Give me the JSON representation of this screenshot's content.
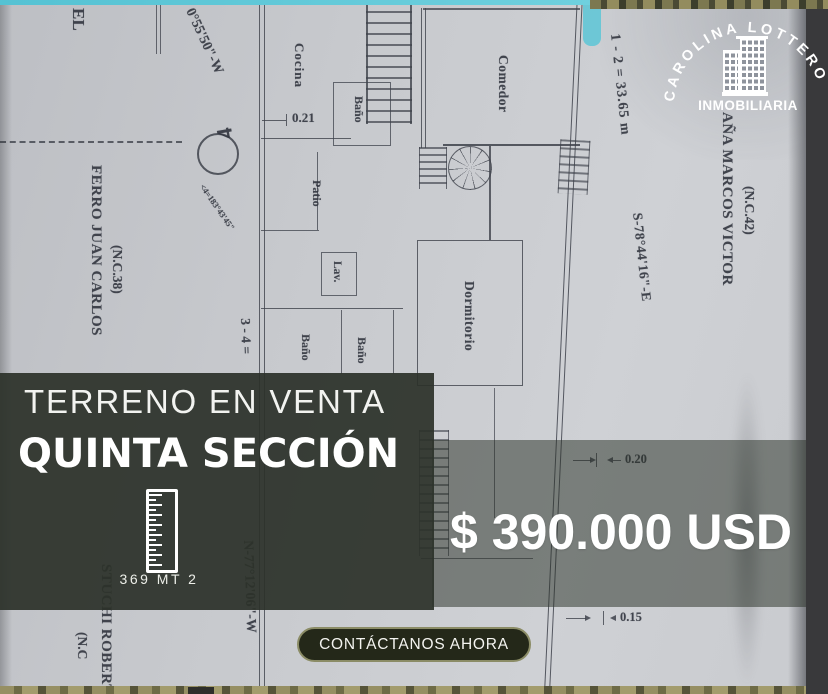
{
  "brand": {
    "arc_text": "CAROLINA LOTTERO",
    "subtitle": "INMOBILIARIA"
  },
  "listing": {
    "headline": "TERRENO EN VENTA",
    "location": "QUINTA SECCIÓN",
    "area_label": "369 MT 2",
    "price": "$ 390.000 USD",
    "cta_label": "CONTÁCTANOS AHORA"
  },
  "plan": {
    "room_labels": {
      "cocina": "Cocina",
      "bano_top": "Baño",
      "patio": "Patio",
      "lav": "Lav.",
      "bano_left": "Baño",
      "bano_mid": "Baño",
      "comedor": "Comedor",
      "dormitorio": "Dormitorio"
    },
    "dimensions": {
      "d021": "0.21",
      "d020": "0.20",
      "d015": "0.15"
    },
    "survey": {
      "bearing_top_left": "0°55'50\"-W",
      "side_1_2": "1 - 2 = 33.65 m",
      "bearing_1_2": "S-78°44'16\"-E",
      "side_3_4": "3 - 4 =",
      "bearing_3_4": "N-77°12'06\"-W",
      "vertex_number": "4",
      "vertex_angle": "<4=183°43'45\""
    },
    "neighbors": {
      "left_name": "FERRO JUAN CARLOS",
      "left_ref": "(N.C.38)",
      "right_name": "AÑA MARCOS VICTOR",
      "right_ref": "(N.C.42)",
      "bottom_name": "STUCHI ROBERT",
      "bottom_ref": "(N.C",
      "top_fragment": "EL"
    }
  },
  "colors": {
    "teal_strip": "#5cc6d6",
    "panel": "#2c312a",
    "price_band": "rgba(43,49,40,0.52)",
    "button_fill": "#242819",
    "button_border": "#8b8c66",
    "text": "#ffffff"
  }
}
